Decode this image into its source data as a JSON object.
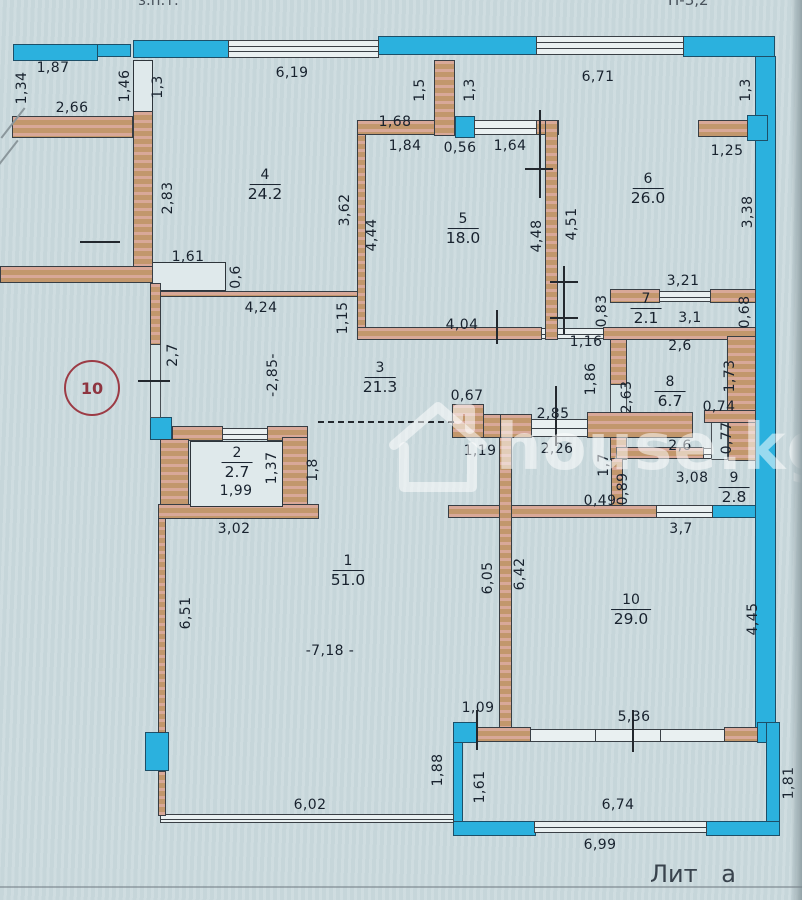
{
  "document": {
    "type": "apartment floor plan (scanned BTI drawing)",
    "footer": {
      "liter_label": "Лит а"
    },
    "top_edge_fragments": {
      "left": "з.п.т.",
      "right": "Н-3,2"
    },
    "stamp_circle": {
      "text": "10"
    },
    "watermark": {
      "text": "house.kg"
    }
  },
  "colors": {
    "paper": "#cbdade",
    "wall_fill": "#c2976c",
    "wall_hatch": "#eeb9c4",
    "window_glass": "#2bb1de",
    "ink": "#18222e",
    "stamp_red": "#9c3b45"
  },
  "rooms": [
    {
      "n": "1",
      "a": "51.0",
      "x": 348,
      "y": 570
    },
    {
      "n": "2",
      "a": "2.7",
      "x": 237,
      "y": 462
    },
    {
      "n": "3",
      "a": "21.3",
      "x": 380,
      "y": 377
    },
    {
      "n": "4",
      "a": "24.2",
      "x": 265,
      "y": 184
    },
    {
      "n": "5",
      "a": "18.0",
      "x": 463,
      "y": 228
    },
    {
      "n": "6",
      "a": "26.0",
      "x": 648,
      "y": 188
    },
    {
      "n": "7",
      "a": "2.1",
      "x": 646,
      "y": 308
    },
    {
      "n": "8",
      "a": "6.7",
      "x": 670,
      "y": 391
    },
    {
      "n": "9",
      "a": "2.8",
      "x": 734,
      "y": 487
    },
    {
      "n": "10",
      "a": "29.0",
      "x": 631,
      "y": 609
    }
  ],
  "dims": [
    {
      "t": "1,87",
      "x": 53,
      "y": 68
    },
    {
      "t": "2,66",
      "x": 72,
      "y": 108
    },
    {
      "t": "6,19",
      "x": 292,
      "y": 73
    },
    {
      "t": "6,71",
      "x": 598,
      "y": 77
    },
    {
      "t": "1,68",
      "x": 395,
      "y": 122
    },
    {
      "t": "1,84",
      "x": 405,
      "y": 146
    },
    {
      "t": "0,56",
      "x": 460,
      "y": 148
    },
    {
      "t": "1,64",
      "x": 510,
      "y": 146
    },
    {
      "t": "1,25",
      "x": 727,
      "y": 151
    },
    {
      "t": "1,61",
      "x": 188,
      "y": 257
    },
    {
      "t": "4,24",
      "x": 261,
      "y": 308
    },
    {
      "t": "3,21",
      "x": 683,
      "y": 281
    },
    {
      "t": "3,1",
      "x": 690,
      "y": 318
    },
    {
      "t": "4,04",
      "x": 462,
      "y": 325
    },
    {
      "t": "1,16",
      "x": 586,
      "y": 342
    },
    {
      "t": "2,6",
      "x": 680,
      "y": 346
    },
    {
      "t": "0,67",
      "x": 467,
      "y": 396
    },
    {
      "t": "2,85",
      "x": 553,
      "y": 414
    },
    {
      "t": "0,74",
      "x": 719,
      "y": 407
    },
    {
      "t": "1,19",
      "x": 480,
      "y": 451
    },
    {
      "t": "2,26",
      "x": 557,
      "y": 449
    },
    {
      "t": "2,6",
      "x": 680,
      "y": 446
    },
    {
      "t": "1,99",
      "x": 236,
      "y": 491
    },
    {
      "t": "3,08",
      "x": 692,
      "y": 478
    },
    {
      "t": "0,49",
      "x": 600,
      "y": 501
    },
    {
      "t": "3,02",
      "x": 234,
      "y": 529
    },
    {
      "t": "3,7",
      "x": 681,
      "y": 529
    },
    {
      "t": "-7,18 -",
      "x": 330,
      "y": 651
    },
    {
      "t": "1,09",
      "x": 478,
      "y": 708
    },
    {
      "t": "5,36",
      "x": 634,
      "y": 717
    },
    {
      "t": "6,02",
      "x": 310,
      "y": 805
    },
    {
      "t": "6,74",
      "x": 618,
      "y": 805
    },
    {
      "t": "6,99",
      "x": 600,
      "y": 845
    },
    {
      "t": "1,34",
      "x": 22,
      "y": 88,
      "v": 1
    },
    {
      "t": "1,46",
      "x": 125,
      "y": 86,
      "v": 1
    },
    {
      "t": "1,3",
      "x": 158,
      "y": 87,
      "v": 1
    },
    {
      "t": "1,5",
      "x": 420,
      "y": 90,
      "v": 1
    },
    {
      "t": "1,3",
      "x": 470,
      "y": 90,
      "v": 1
    },
    {
      "t": "1,3",
      "x": 746,
      "y": 90,
      "v": 1
    },
    {
      "t": "2,83",
      "x": 168,
      "y": 198,
      "v": 1
    },
    {
      "t": "3,62",
      "x": 345,
      "y": 210,
      "v": 1
    },
    {
      "t": "4,44",
      "x": 372,
      "y": 235,
      "v": 1
    },
    {
      "t": "4,48",
      "x": 537,
      "y": 236,
      "v": 1
    },
    {
      "t": "4,51",
      "x": 572,
      "y": 224,
      "v": 1
    },
    {
      "t": "3,38",
      "x": 748,
      "y": 212,
      "v": 1
    },
    {
      "t": "0,6",
      "x": 236,
      "y": 277,
      "v": 1
    },
    {
      "t": "1,15",
      "x": 343,
      "y": 318,
      "v": 1
    },
    {
      "t": "0,83",
      "x": 602,
      "y": 311,
      "v": 1
    },
    {
      "t": "0,68",
      "x": 745,
      "y": 312,
      "v": 1
    },
    {
      "t": "2,7",
      "x": 173,
      "y": 355,
      "v": 1
    },
    {
      "t": "-2,85-",
      "x": 273,
      "y": 375,
      "v": 1
    },
    {
      "t": "1,86",
      "x": 591,
      "y": 379,
      "v": 1
    },
    {
      "t": "2,63",
      "x": 627,
      "y": 397,
      "v": 1
    },
    {
      "t": "1,73",
      "x": 730,
      "y": 376,
      "v": 1
    },
    {
      "t": "0,77",
      "x": 727,
      "y": 438,
      "v": 1
    },
    {
      "t": "1,7",
      "x": 604,
      "y": 465,
      "v": 1
    },
    {
      "t": "1,37",
      "x": 272,
      "y": 468,
      "v": 1
    },
    {
      "t": "1,8",
      "x": 313,
      "y": 470,
      "v": 1
    },
    {
      "t": "0,89",
      "x": 623,
      "y": 489,
      "v": 1
    },
    {
      "t": "6,51",
      "x": 186,
      "y": 613,
      "v": 1
    },
    {
      "t": "6,05",
      "x": 488,
      "y": 578,
      "v": 1
    },
    {
      "t": "6,42",
      "x": 520,
      "y": 574,
      "v": 1
    },
    {
      "t": "4,45",
      "x": 753,
      "y": 619,
      "v": 1
    },
    {
      "t": "1,88",
      "x": 438,
      "y": 770,
      "v": 1
    },
    {
      "t": "1,61",
      "x": 480,
      "y": 787,
      "v": 1
    },
    {
      "t": "1,81",
      "x": 789,
      "y": 783,
      "v": 1
    }
  ]
}
